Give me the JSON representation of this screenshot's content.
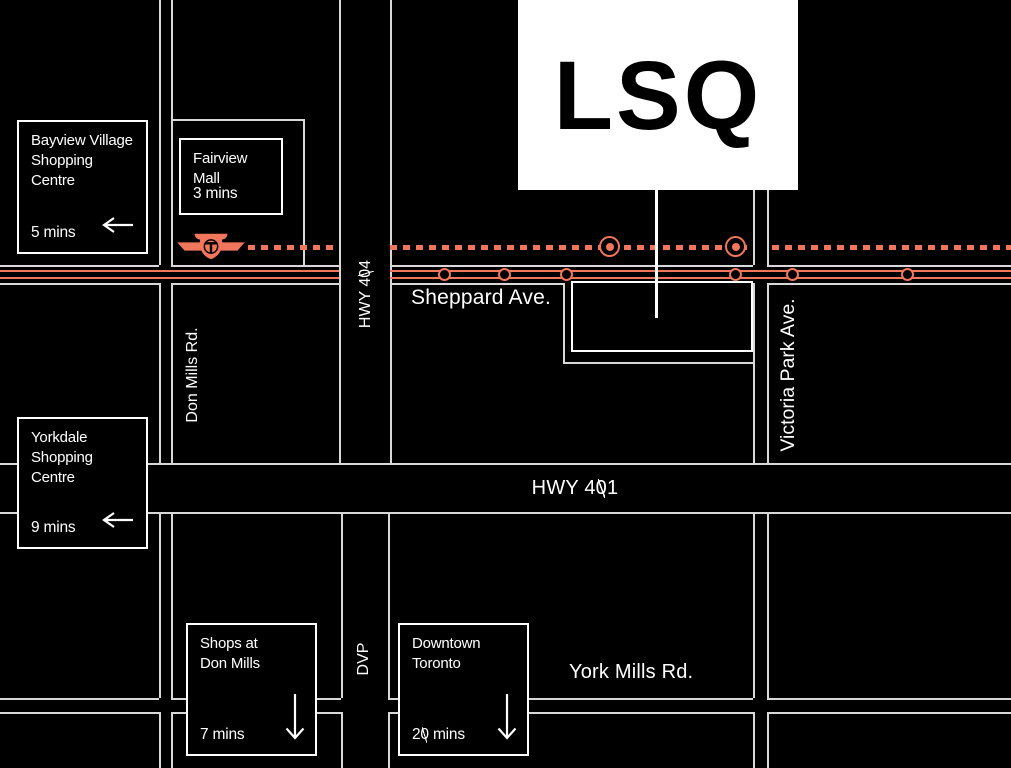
{
  "lsq": {
    "label": "LSQ"
  },
  "streets": {
    "sheppard": "Sheppard Ave.",
    "hwy404": "HWY 404",
    "hwy401": "HWY 401",
    "don_mills": "Don Mills Rd.",
    "victoria_park": "Victoria Park Ave.",
    "dvp": "DVP",
    "york_mills": "York Mills Rd."
  },
  "destinations": {
    "bayview": {
      "name": "Bayview Village\nShopping\nCentre",
      "time": "5 mins",
      "arrow": "left"
    },
    "fairview": {
      "name": "Fairview\nMall",
      "time": "3 mins",
      "arrow": "none"
    },
    "yorkdale": {
      "name": "Yorkdale\nShopping\nCentre",
      "time": "9 mins",
      "arrow": "left"
    },
    "shops_at_don_mills": {
      "name": "Shops at\nDon Mills",
      "time": "7 mins",
      "arrow": "down"
    },
    "downtown": {
      "name": "Downtown\nToronto",
      "time": "20 mins",
      "arrow": "down"
    }
  },
  "transit": {
    "agency_logo": "ttc-logo",
    "subway_major_stations": 2,
    "surface_stops": 6
  },
  "colors": {
    "background": "#000000",
    "accent_coral": "#F1765B",
    "grid_line": "#D8D8D8",
    "box_border": "#FFFFFF",
    "text": "#FFFFFF",
    "lsq_box_bg": "#FFFFFF",
    "lsq_text": "#000000"
  }
}
